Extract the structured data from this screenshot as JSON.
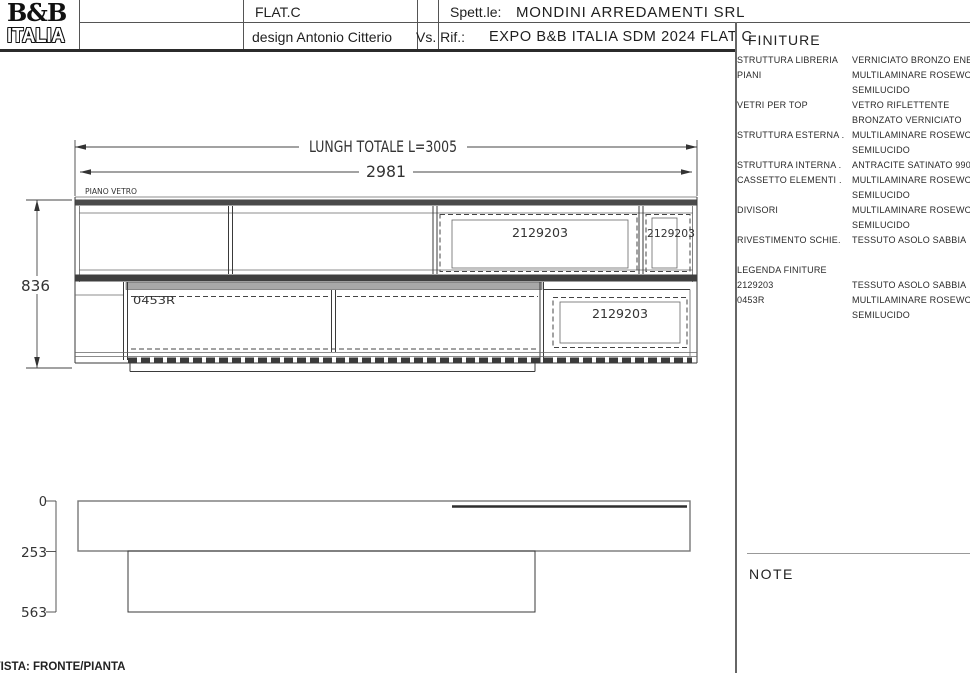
{
  "header": {
    "logo": {
      "line1": "B&B",
      "line2": "ITALIA"
    },
    "product_name": "FLAT.C",
    "designer": "design Antonio Citterio",
    "client_label": "Spett.le:",
    "client_value": "MONDINI ARREDAMENTI SRL",
    "reference_label": "Vs. Rif.:",
    "reference_value": "EXPO B&B ITALIA SDM 2024 FLAT C"
  },
  "finiture": {
    "title": "FINITURE",
    "rows": [
      {
        "label": "STRUTTURA LIBRERIA",
        "value": "VERNICIATO BRONZO ENEO"
      },
      {
        "label": "PIANI",
        "value": "MULTILAMINARE ROSEWOOD"
      },
      {
        "label": "",
        "value": "SEMILUCIDO"
      },
      {
        "label": "VETRI PER TOP",
        "value": "VETRO RIFLETTENTE"
      },
      {
        "label": "",
        "value": "BRONZATO VERNICIATO"
      },
      {
        "label": "STRUTTURA ESTERNA .",
        "value": "MULTILAMINARE ROSEWOOD"
      },
      {
        "label": "",
        "value": "SEMILUCIDO"
      },
      {
        "label": "STRUTTURA INTERNA .",
        "value": "ANTRACITE SATINATO 9907"
      },
      {
        "label": "CASSETTO ELEMENTI .",
        "value": "MULTILAMINARE ROSEWOOD"
      },
      {
        "label": "",
        "value": "SEMILUCIDO"
      },
      {
        "label": "DIVISORI",
        "value": "MULTILAMINARE ROSEWOOD"
      },
      {
        "label": "",
        "value": "SEMILUCIDO"
      },
      {
        "label": "RIVESTIMENTO SCHIE.",
        "value": "TESSUTO ASOLO SABBIA"
      },
      {
        "label": "",
        "value": ""
      },
      {
        "label": "LEGENDA FINITURE",
        "value": ""
      },
      {
        "label": "2129203",
        "value": "TESSUTO ASOLO SABBIA"
      },
      {
        "label": "0453R",
        "value": "MULTILAMINARE ROSEWOOD"
      },
      {
        "label": "",
        "value": "SEMILUCIDO"
      }
    ],
    "note_title": "NOTE"
  },
  "drawing": {
    "front_view": {
      "dim_total_length": "LUNGH TOTALE L=3005",
      "dim_inner_length": "2981",
      "dim_height": "836",
      "glass_top_label": "PIANO VETRO",
      "finish_code_drawer": "0453R",
      "finish_code_fabric": "2129203"
    },
    "plan_view": {
      "depth_ticks": [
        "0",
        "253",
        "563"
      ]
    },
    "view_caption": "VISTA: FRONTE/PIANTA"
  },
  "colors": {
    "line": "#3a3a3a",
    "dark_band": "#3f3f3f",
    "gray_band": "#a8a8a8",
    "page_bg": "#ffffff"
  }
}
